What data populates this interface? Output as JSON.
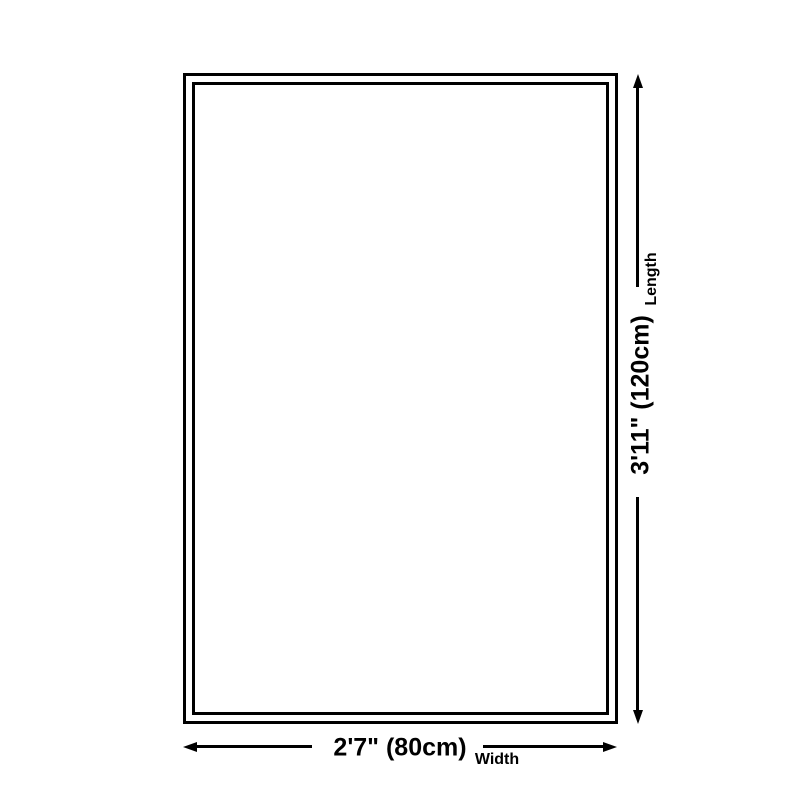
{
  "theme": {
    "bg": "#ffffff",
    "line": "#000000",
    "text": "#000000"
  },
  "diagram": {
    "description": "product-size-diagram",
    "length": {
      "value": "3'11\" (120cm)",
      "label": "Length"
    },
    "width": {
      "value": "2'7\" (80cm)",
      "label": "Width"
    }
  }
}
